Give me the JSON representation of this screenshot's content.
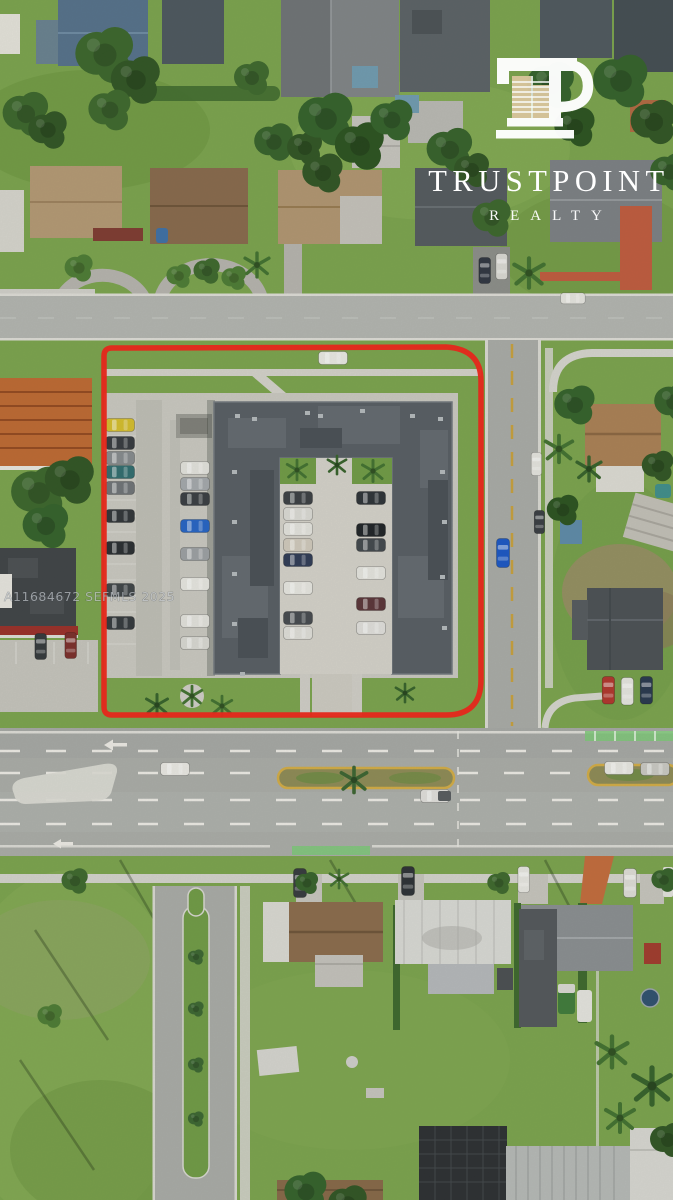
{
  "meta": {
    "width": 673,
    "height": 1200,
    "type": "aerial-real-estate-listing-photo",
    "subject": "Aerial drone photo of a U-shaped commercial apartment building and its parking lot outlined in red, on a corner lot between a residential side street and a multi-lane main road, surrounded by single-family homes"
  },
  "branding": {
    "name": "TRUSTPOINT",
    "subtitle": "REALTY",
    "monogram": "TP",
    "color": "#ffffff",
    "monogram_building_color": "#d6c49a"
  },
  "mls_watermark": {
    "listing_id": "A11684672",
    "mls_name": "SEFMLS",
    "year": "2025",
    "text": "A11684672  SEFMLS  2025"
  },
  "annotations": {
    "property_boundary_color": "#ee2418",
    "property_boundary_shape": "rounded-rectangle outline around subject parcel"
  },
  "scene": {
    "palette": {
      "grass": "#7aa24c",
      "grass_dark": "#5d8a38",
      "grass_dry": "#9aa96a",
      "tree": "#3c672c",
      "tree_dark": "#2f5423",
      "asphalt": "#abadab",
      "asphalt_light": "#b3b5b1",
      "concrete_lot": "#c9c7c0",
      "sidewalk": "#d5d4ce",
      "roof_dark": "#565c63",
      "roof_gray": "#898d90",
      "roof_white": "#d8d8d4",
      "roof_tan": "#b39873",
      "roof_brown": "#87684b",
      "roof_blue": "#54708a",
      "roof_tile_orange": "#bd6831",
      "median_yellow": "#d2ab45",
      "median_grass": "#8d8a55",
      "marking_white": "#eceae5",
      "paint_green": "#7cc878",
      "clay_red": "#bf5a3d",
      "boundary_red": "#ee2418",
      "highlight_car_blue": "#1a56c4",
      "highlight_car_yellow": "#d4bc2b"
    }
  }
}
